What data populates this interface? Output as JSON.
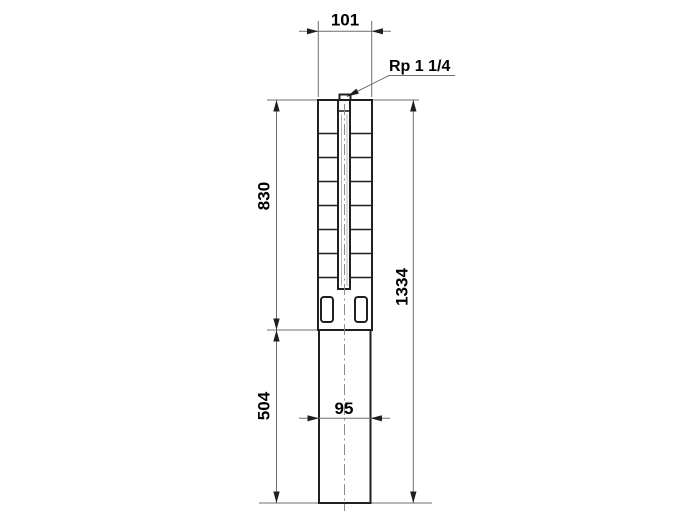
{
  "drawing": {
    "connection_label": "Rp 1 1/4",
    "dimensions": {
      "top_width": "101",
      "upper_length": "830",
      "total_length": "1334",
      "lower_length": "504",
      "motor_width": "95"
    },
    "colors": {
      "background": "#ffffff",
      "outline": "#1f1f1f",
      "thin": "#6f6f6f",
      "centerline": "#8c8c8c",
      "arrow": "#1f1f1f",
      "text": "#000000"
    }
  }
}
